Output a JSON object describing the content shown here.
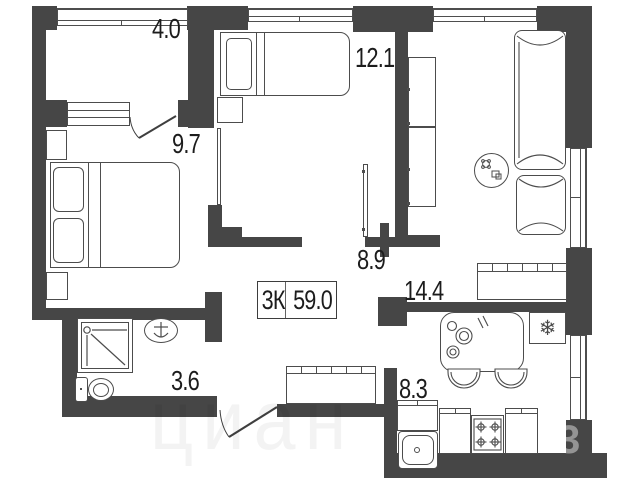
{
  "plan": {
    "unit_label": "3К",
    "total_area": "59.0",
    "rooms": {
      "balcony": {
        "name": "balcony",
        "area": "4.0"
      },
      "bedroom1": {
        "name": "bedroom-1",
        "area": "9.7"
      },
      "bedroom2": {
        "name": "bedroom-2",
        "area": "12.1"
      },
      "hallway": {
        "name": "hallway",
        "area": "8.9"
      },
      "living": {
        "name": "living-room",
        "area": "14.4"
      },
      "kitchen": {
        "name": "kitchen",
        "area": "8.3"
      },
      "bathroom": {
        "name": "bathroom",
        "area": "3.6"
      }
    },
    "icons": {
      "fridge_glyph": "❄",
      "fridge_icon": "snowflake-icon"
    },
    "watermark": {
      "text": "циан",
      "digit": "3"
    },
    "colors": {
      "wall": "#464646",
      "line": "#4c4c4c",
      "text": "#1c1c1c"
    }
  }
}
